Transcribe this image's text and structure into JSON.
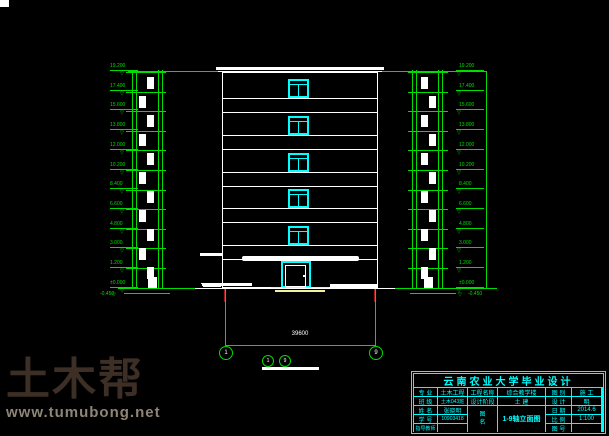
{
  "colors": {
    "green": "#00dd00",
    "cyan": "#00ffff",
    "white": "#ffffff",
    "yellow": "#f0f0a0",
    "red": "#a51212"
  },
  "elevation_markers": {
    "values": [
      "19.200",
      "17.400",
      "15.600",
      "13.800",
      "12.000",
      "10.200",
      "8.400",
      "6.600",
      "4.800",
      "3.000",
      "1.200",
      "±0.000"
    ],
    "basement": "-0.450"
  },
  "dimension": {
    "total": "39600",
    "axis_left": "1",
    "axis_right": "9"
  },
  "drawing_title": {
    "bubble_a": "1",
    "bubble_b": "9"
  },
  "titleblock": {
    "title": "云南农业大学毕业设计",
    "rows": [
      {
        "label": "专 业",
        "value": "土木工程"
      },
      {
        "label": "班 级",
        "value": "土木043班"
      },
      {
        "label": "姓 名",
        "value": "张晓明"
      },
      {
        "label": "学 号",
        "value": "10903418"
      },
      {
        "label": "指导教师",
        "value": ""
      }
    ],
    "project_label": "工程名称",
    "project_value": "综合教学楼",
    "stage_label": "设计阶段",
    "stage_value": "土 建",
    "sheet_label_1": "图",
    "sheet_label_2": "名",
    "sheet_value": "1-9轴立面图",
    "right_rows": [
      {
        "label": "图 别",
        "value": "施 工"
      },
      {
        "label": "设 计",
        "value": "明"
      },
      {
        "label": "日 期",
        "value": "2014.6"
      },
      {
        "label": "比 例",
        "value": "1:100"
      },
      {
        "label": "图 号",
        "value": ""
      }
    ]
  },
  "watermark": {
    "brand": "土木帮",
    "url": "www.tumubong.net"
  }
}
